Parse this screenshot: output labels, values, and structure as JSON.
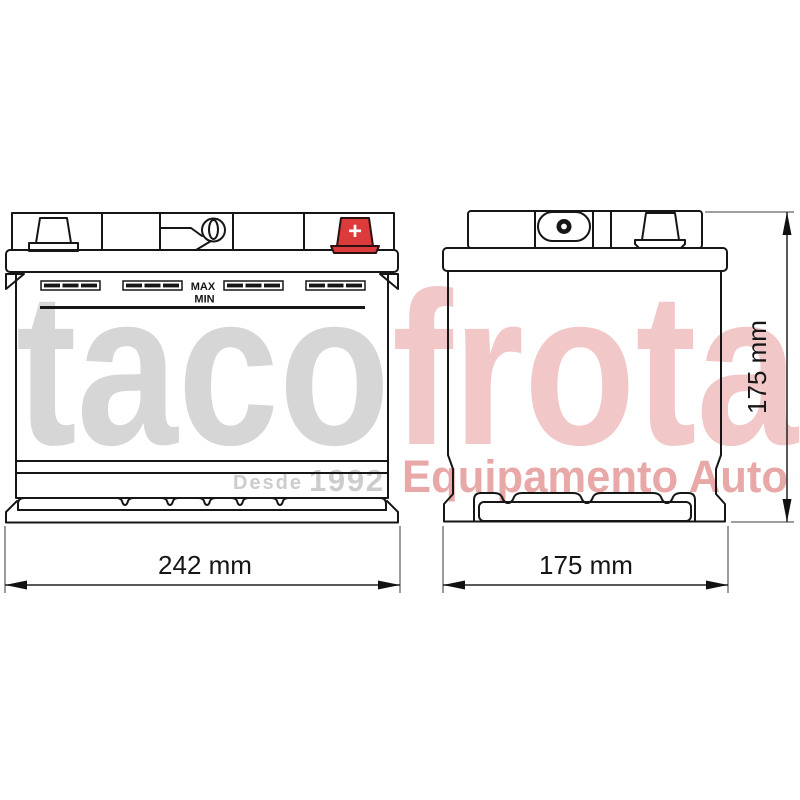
{
  "diagram": {
    "front_view": {
      "max_label": "MAX",
      "min_label": "MIN",
      "width_dimension": "242 mm",
      "positive_terminal_symbol": "+",
      "positive_terminal_color": "#dd3b3b"
    },
    "side_view": {
      "width_dimension": "175 mm",
      "height_dimension": "175 mm"
    },
    "line_color": "#161616"
  },
  "watermark": {
    "brand_part1": "taco",
    "brand_part2": "frota",
    "brand_part1_color": "#d6d6d6",
    "brand_part2_color": "#f1c7c7",
    "since_label": "Desde",
    "since_year": "1992",
    "since_color": "#cccccc",
    "tagline": "Equipamento Auto",
    "tagline_color": "#e9a8a8"
  }
}
